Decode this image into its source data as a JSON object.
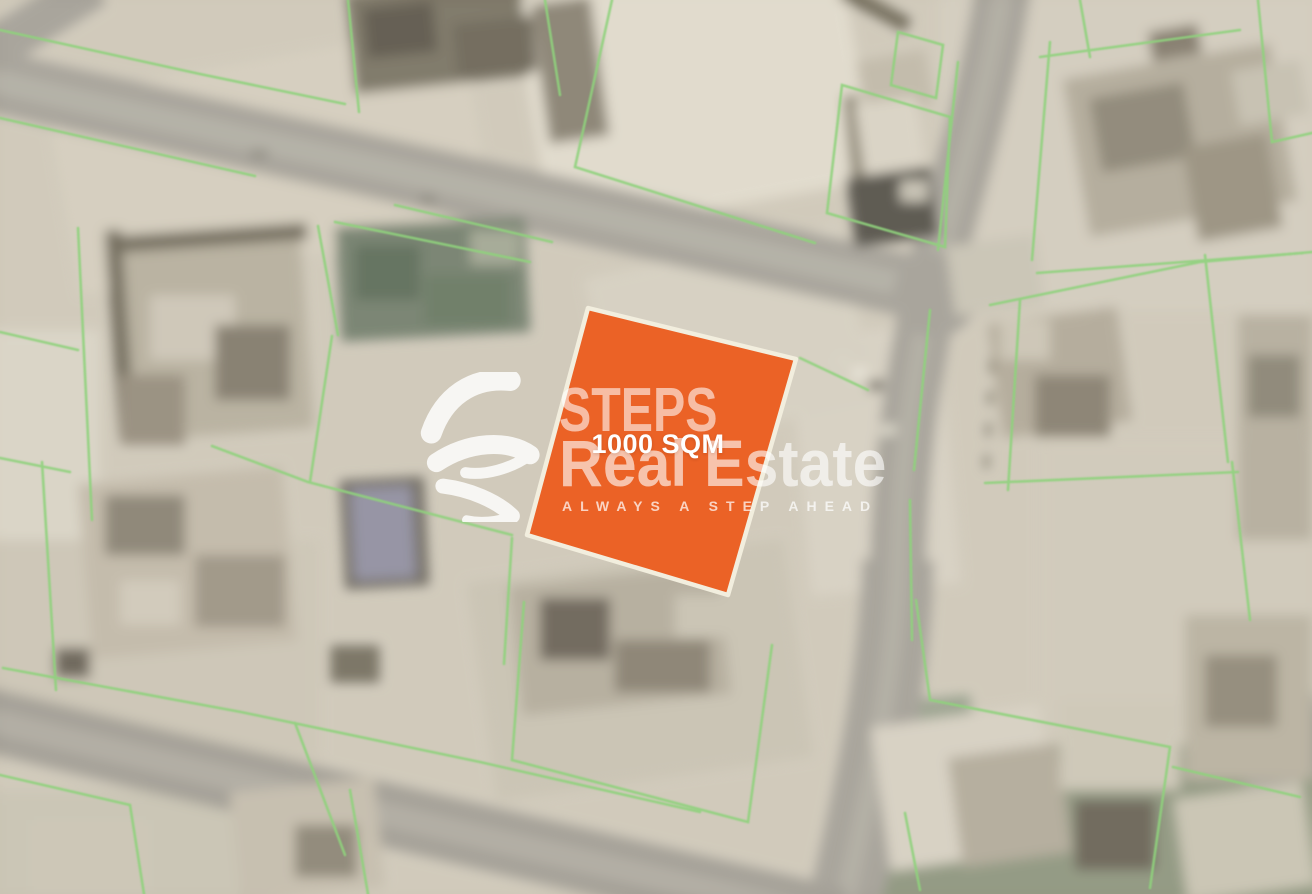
{
  "image": {
    "kind": "blurred satellite map with highlighted land plot",
    "width_px": 1312,
    "height_px": 894
  },
  "map": {
    "base_color": "#cfc8b8",
    "road_color": "#a5a197",
    "parcel_line_color": "#8fd27d",
    "vegetation_color": "#74806d"
  },
  "highlighted_plot": {
    "label": "1000 SQM",
    "fill_color": "#eb6226",
    "border_color": "#f2eede",
    "polygon_points": "588,308 796,359 728,595 527,535"
  },
  "watermark": {
    "logo": "steps-swoosh-icon",
    "brand_line1": "STEPS",
    "brand_line2": "Real Estate",
    "tagline": "ALWAYS A STEP AHEAD",
    "text_color": "#ffffff"
  }
}
